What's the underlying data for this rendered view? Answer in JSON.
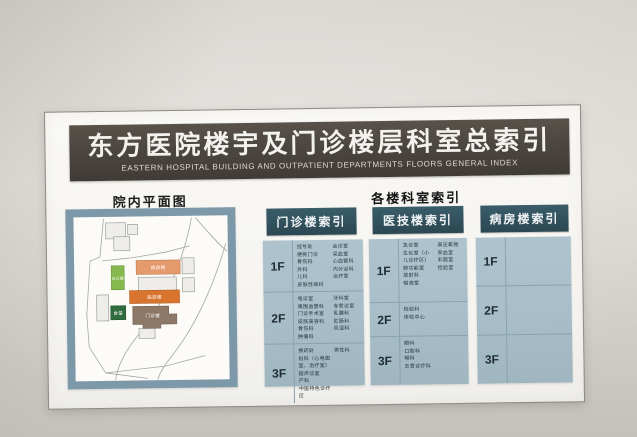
{
  "board": {
    "title_zh": "东方医院楼宇及门诊楼层科室总索引",
    "title_en": "EASTERN HOSPITAL BUILDING AND OUTPATIENT DEPARTMENTS FLOORS GENERAL INDEX"
  },
  "map": {
    "title": "院内平面图",
    "buildings": [
      {
        "label": "病房楼",
        "color": "#e59a6d"
      },
      {
        "label": "医技楼",
        "color": "#d9742f"
      },
      {
        "label": "门诊楼",
        "color": "#8d7766"
      },
      {
        "label": "办公楼",
        "color": "#86b94d"
      },
      {
        "label": "食堂",
        "color": "#2f6b3c"
      }
    ]
  },
  "index_header": "各楼科室索引",
  "columns": [
    {
      "header": "门诊楼索引",
      "rows": [
        {
          "floor": "1F",
          "col_a": "挂号处\n便民门诊\n骨伤科\n外科\n儿科\n皮肤性病科",
          "col_b": "会诊室\n采血室\n心血管科\n内分泌科\n治疗室"
        },
        {
          "floor": "2F",
          "col_a": "电诊室\n周围血管科\n门诊手术室\n皮肤美容科\n骨伤科\n肿瘤科",
          "col_b": "牙科室\n专家诊室\n乳腺科\n肛肠科\n风湿科"
        },
        {
          "floor": "3F",
          "col_a": "换药处\n妇科（心电图室、治疗室）\n超声诊室\n产科\n中医特色诊疗区",
          "col_b": "男性科"
        }
      ]
    },
    {
      "header": "医技楼索引",
      "rows": [
        {
          "floor": "1F",
          "col_a": "急诊室\n生化室（小儿诊疗区）\n肺功能室\n放射科\n输液室",
          "col_b": "高压氧舱\n采血室\n彩超室\n检验室"
        },
        {
          "floor": "2F",
          "col_a": "检验科\n体检中心",
          "col_b": ""
        },
        {
          "floor": "3F",
          "col_a": "眼科\n口腔科\n喉科\n五官诊疗科",
          "col_b": ""
        }
      ]
    },
    {
      "header": "病房楼索引",
      "rows": [
        {
          "floor": "1F",
          "col_a": "",
          "col_b": ""
        },
        {
          "floor": "2F",
          "col_a": "",
          "col_b": ""
        },
        {
          "floor": "3F",
          "col_a": "",
          "col_b": ""
        }
      ]
    }
  ],
  "colors": {
    "title_bar": "#4c4640",
    "column_header_teal": "#31505c",
    "table_blue": "#a7bdc8",
    "map_frame_blue": "#7d99a9"
  }
}
